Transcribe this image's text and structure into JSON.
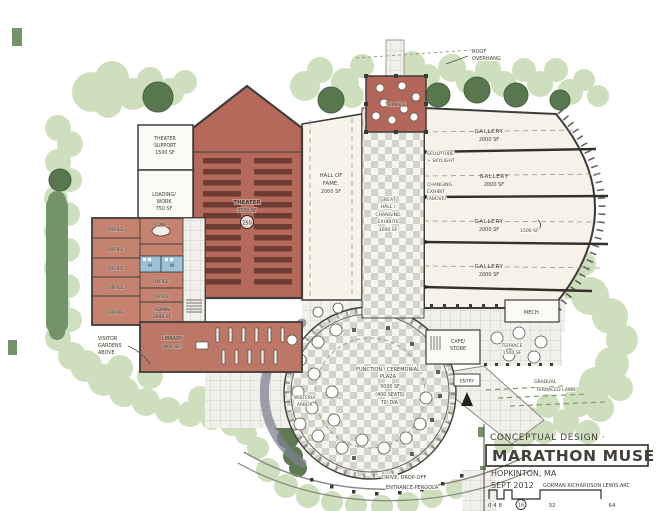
{
  "title_block": {
    "note": "CONCEPTUAL DESIGN ·",
    "project": "MARATHON MUSEUM",
    "location": "HOPKINTON, MA",
    "date": "SEPT 2012",
    "architect": "GORMAN RICHARDSON LEWIS ARC",
    "scale_ticks": {
      "a": "0 4 8",
      "b": "16",
      "c": "32",
      "d": "64"
    }
  },
  "rooms": {
    "theater": {
      "name": "THEATER",
      "area": "3500 SF",
      "seats": "250"
    },
    "theater_support": {
      "l1": "THEATER",
      "l2": "SUPPORT",
      "area": "1500 SF"
    },
    "loading": {
      "l1": "LOADING/",
      "l2": "WORK",
      "area": "750 SF"
    },
    "offices": [
      "OFFICE",
      "OFFICE",
      "OFFICE",
      "OFFICE",
      "OFFICE",
      "OFFICE",
      "OFFICE"
    ],
    "conf": "CONF.",
    "men": "M",
    "women": "W",
    "admin": {
      "name": "ADMIN",
      "area": "2000 SF"
    },
    "library": {
      "name": "LIBRARY",
      "area": "(800 SF)"
    },
    "hall_of_fame": {
      "l1": "HALL OF",
      "l2": "FAME,",
      "area": "2000 SF"
    },
    "great_hall": {
      "l1": "GREAT",
      "l2": "HALL /",
      "l3": "CHANGING",
      "l4": "EXHIBITS",
      "area": "3000 SF"
    },
    "galleries": [
      {
        "name": "GALLERY",
        "area": "2000 SF"
      },
      {
        "name": "GALLERY",
        "area": "2000 SF"
      },
      {
        "name": "GALLERY",
        "area": "2000 SF"
      },
      {
        "name": "GALLERY",
        "area": "2000 SF"
      }
    ],
    "mech": "MECH.",
    "entry": "ENTRY",
    "cafe": {
      "l1": "CAFE/",
      "l2": "STORE"
    },
    "terrace": {
      "name": "TERRACE",
      "area": "1500 SF"
    },
    "roof_terrace": "TERRACE",
    "plaza": {
      "l1": "FUNCTION / CEREMONIAL",
      "l2": "PLAZA",
      "area": "5000 SF",
      "seats": "(400 SEATS)",
      "dia": "70' DIA."
    }
  },
  "annotations": {
    "roof": {
      "l1": "ROOF",
      "l2": "OVERHANG"
    },
    "sculpture": {
      "l1": "SCULPTURE",
      "l2": "+ SKYLIGHT"
    },
    "changing": {
      "l1": "CHANGING",
      "l2": "EXHIBIT",
      "l3": "(ABOVE)"
    },
    "gallery_alt": "1500 SF",
    "visitor": {
      "l1": "VISITOR",
      "l2": "GARDENS",
      "l3": "ABOVE"
    },
    "wisteria": {
      "l1": "WISTERIA",
      "l2": "ARBOR"
    },
    "drive": "DRIVE, DROP-OFF",
    "pergola": "ENTRANCE PERGOLA",
    "lawn": {
      "l1": "GRADUAL",
      "l2": "TERRACED LAWN"
    }
  },
  "colors": {
    "paper": "#ffffff",
    "ink": "#45403a",
    "brick": "#b5695a",
    "brick_light": "#c4826f",
    "seat_maroon": "#6f3c33",
    "foliage_light": "#cddfbc",
    "foliage_dark": "#58774f",
    "hedge": "#74936a",
    "restroom_blue": "#9cc2d8",
    "paving_gray": "#d3d2cb",
    "gallery_cream": "#f6f2e9"
  }
}
